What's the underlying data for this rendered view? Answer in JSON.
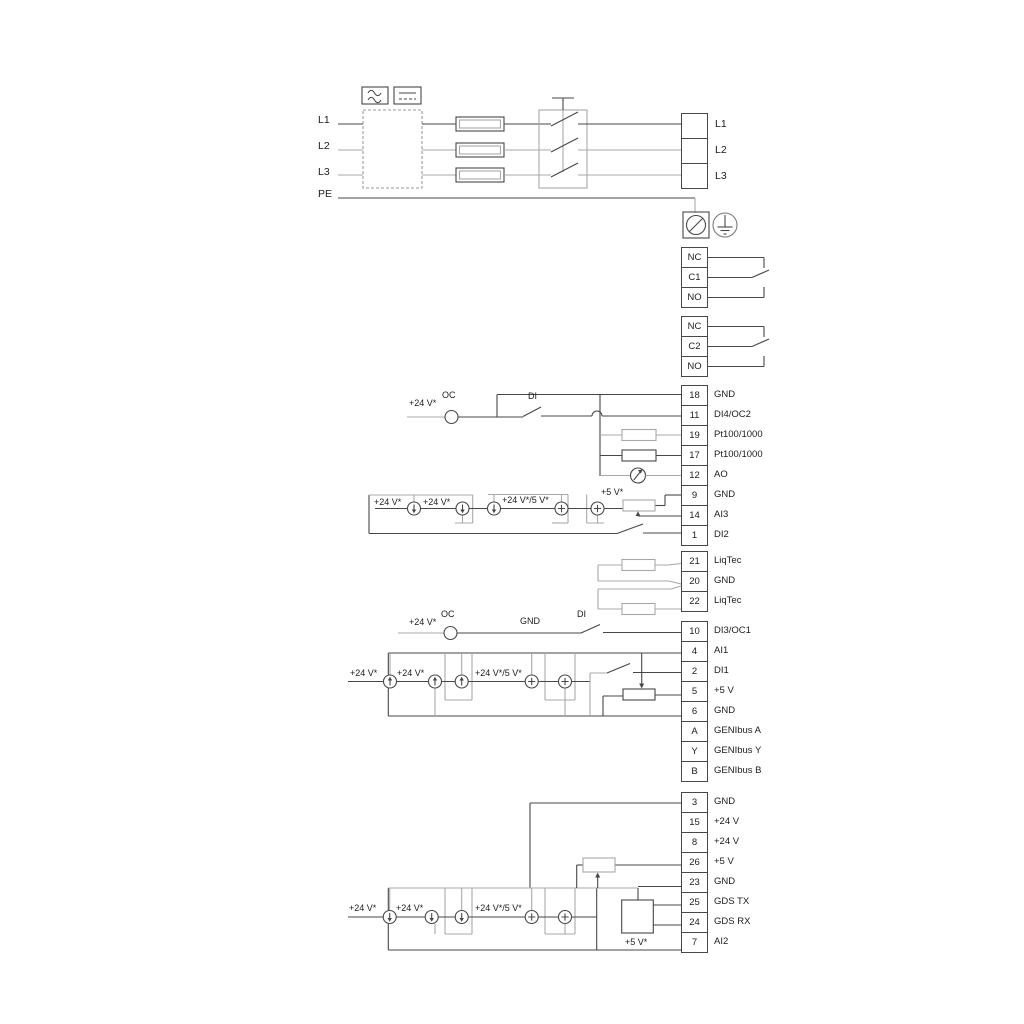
{
  "power": {
    "inputs": [
      "L1",
      "L2",
      "L3",
      "PE"
    ],
    "outputs": [
      "L1",
      "L2",
      "L3"
    ]
  },
  "relays": {
    "relay1": [
      "NC",
      "C1",
      "NO"
    ],
    "relay2": [
      "NC",
      "C2",
      "NO"
    ]
  },
  "terminal_groups": {
    "group1": [
      {
        "num": "18",
        "label": "GND"
      },
      {
        "num": "11",
        "label": "DI4/OC2"
      },
      {
        "num": "19",
        "label": "Pt100/1000"
      },
      {
        "num": "17",
        "label": "Pt100/1000"
      },
      {
        "num": "12",
        "label": "AO"
      },
      {
        "num": "9",
        "label": "GND"
      },
      {
        "num": "14",
        "label": "AI3"
      },
      {
        "num": "1",
        "label": "DI2"
      }
    ],
    "group2": [
      {
        "num": "21",
        "label": "LiqTec"
      },
      {
        "num": "20",
        "label": "GND"
      },
      {
        "num": "22",
        "label": "LiqTec"
      }
    ],
    "group3": [
      {
        "num": "10",
        "label": "DI3/OC1"
      },
      {
        "num": "4",
        "label": "AI1"
      },
      {
        "num": "2",
        "label": "DI1"
      },
      {
        "num": "5",
        "label": "+5 V"
      },
      {
        "num": "6",
        "label": "GND"
      },
      {
        "num": "A",
        "label": "GENIbus A"
      },
      {
        "num": "Y",
        "label": "GENIbus Y"
      },
      {
        "num": "B",
        "label": "GENIbus B"
      }
    ],
    "group4": [
      {
        "num": "3",
        "label": "GND"
      },
      {
        "num": "15",
        "label": "+24 V"
      },
      {
        "num": "8",
        "label": "+24 V"
      },
      {
        "num": "26",
        "label": "+5 V"
      },
      {
        "num": "23",
        "label": "GND"
      },
      {
        "num": "25",
        "label": "GDS TX"
      },
      {
        "num": "24",
        "label": "GDS RX"
      },
      {
        "num": "7",
        "label": "AI2"
      }
    ]
  },
  "annotations": {
    "di4_row": {
      "v24": "+24 V*",
      "oc": "OC",
      "di": "DI"
    },
    "ai3_row": {
      "v24_1": "+24 V*",
      "v24_2": "+24 V*",
      "v24_5": "+24 V*/5 V*",
      "v5": "+5 V*"
    },
    "di3_row": {
      "v24": "+24 V*",
      "oc": "OC",
      "gnd": "GND",
      "di": "DI"
    },
    "ai1_row": {
      "v24_1": "+24 V*",
      "v24_2": "+24 V*",
      "v24_5": "+24 V*/5 V*"
    },
    "ai2_row": {
      "v24_1": "+24 V*",
      "v24_2": "+24 V*",
      "v24_5": "+24 V*/5 V*",
      "v5": "+5 V*"
    }
  },
  "colors": {
    "line_dark": "#474747",
    "line_gray": "#a8a8a8",
    "text": "#1c1c1c",
    "bg": "#ffffff"
  }
}
